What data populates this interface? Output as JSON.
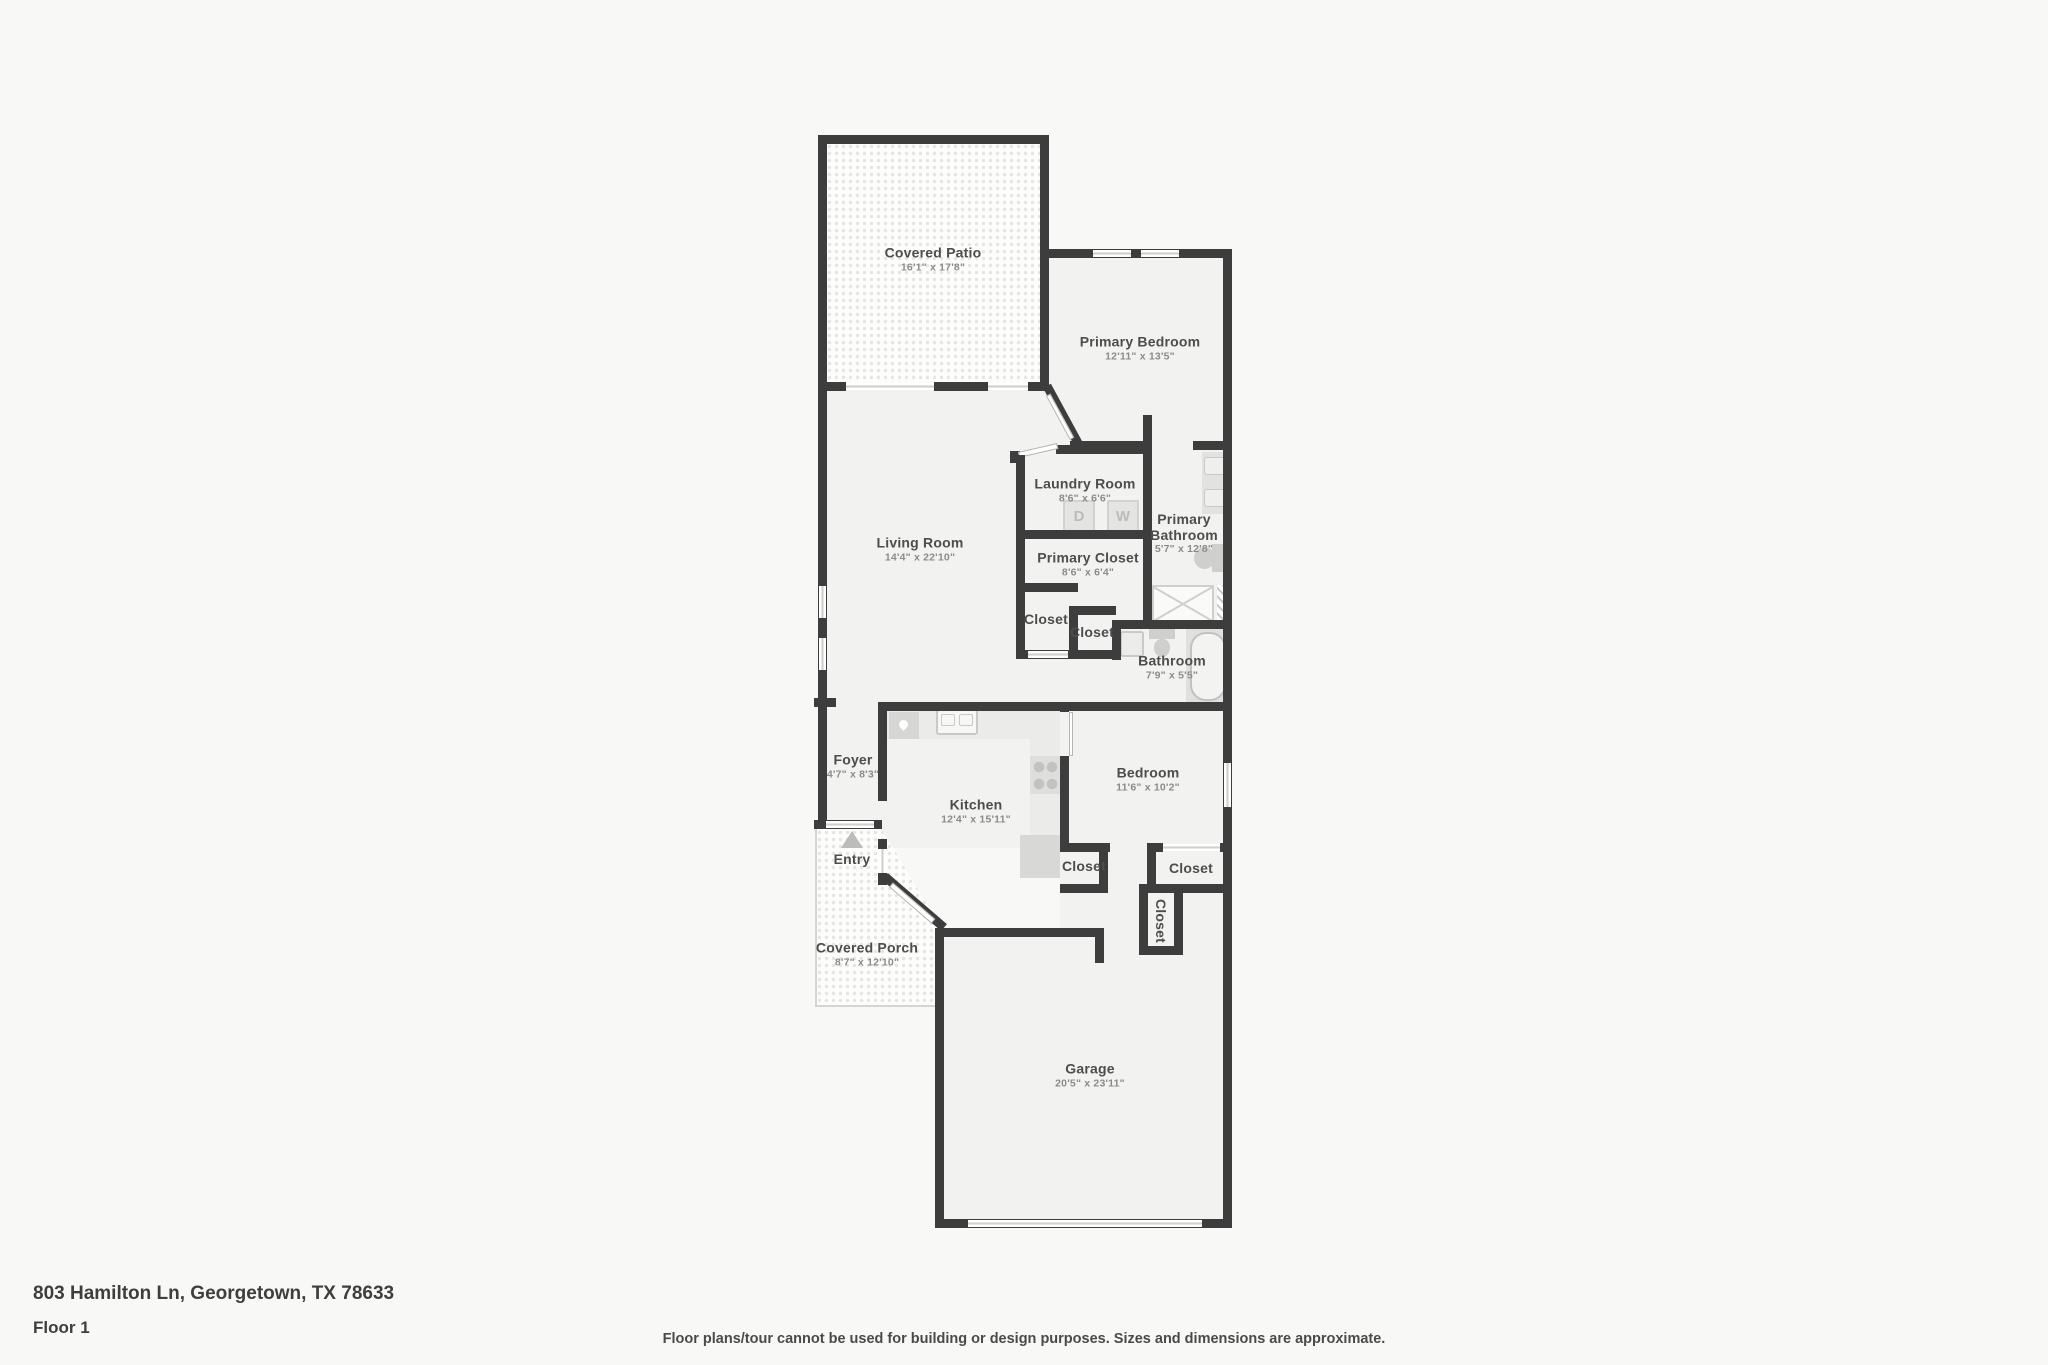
{
  "plan": {
    "rooms": [
      {
        "id": "covered-patio",
        "name": "Covered Patio",
        "dims": "16'1\" x 17'8\""
      },
      {
        "id": "primary-bedroom",
        "name": "Primary Bedroom",
        "dims": "12'11\" x 13'5\""
      },
      {
        "id": "living-room",
        "name": "Living Room",
        "dims": "14'4\" x 22'10\""
      },
      {
        "id": "laundry-room",
        "name": "Laundry Room",
        "dims": "8'6\" x 6'6\""
      },
      {
        "id": "primary-bathroom",
        "name": "Primary Bathroom",
        "dims": "5'7\" x 12'8\""
      },
      {
        "id": "primary-closet",
        "name": "Primary Closet",
        "dims": "8'6\" x 6'4\""
      },
      {
        "id": "closet-hall-a",
        "name": "Closet",
        "dims": ""
      },
      {
        "id": "closet-hall-b",
        "name": "Closet",
        "dims": ""
      },
      {
        "id": "bathroom",
        "name": "Bathroom",
        "dims": "7'9\" x 5'5\""
      },
      {
        "id": "foyer",
        "name": "Foyer",
        "dims": "4'7\" x 8'3\""
      },
      {
        "id": "kitchen",
        "name": "Kitchen",
        "dims": "12'4\" x 15'11\""
      },
      {
        "id": "bedroom",
        "name": "Bedroom",
        "dims": "11'6\" x 10'2\""
      },
      {
        "id": "entry",
        "name": "Entry",
        "dims": ""
      },
      {
        "id": "closet-kitchen",
        "name": "Closet",
        "dims": ""
      },
      {
        "id": "closet-bedroom",
        "name": "Closet",
        "dims": ""
      },
      {
        "id": "closet-vertical",
        "name": "Closet",
        "dims": ""
      },
      {
        "id": "covered-porch",
        "name": "Covered Porch",
        "dims": "8'7\" x 12'10\""
      },
      {
        "id": "garage",
        "name": "Garage",
        "dims": "20'5\" x 23'11\""
      }
    ],
    "appliances": {
      "dryer_label": "D",
      "washer_label": "W"
    }
  },
  "footer": {
    "address": "803 Hamilton Ln, Georgetown, TX 78633",
    "floor_label": "Floor 1",
    "disclaimer": "Floor plans/tour cannot be used for building or design purposes. Sizes and dimensions are approximate."
  },
  "colors": {
    "wall": "#3d3d3d",
    "floor": "#f2f2f1",
    "background": "#f8f8f7",
    "fixture": "#d6d6d4",
    "label_text": "#4d4d4d"
  }
}
